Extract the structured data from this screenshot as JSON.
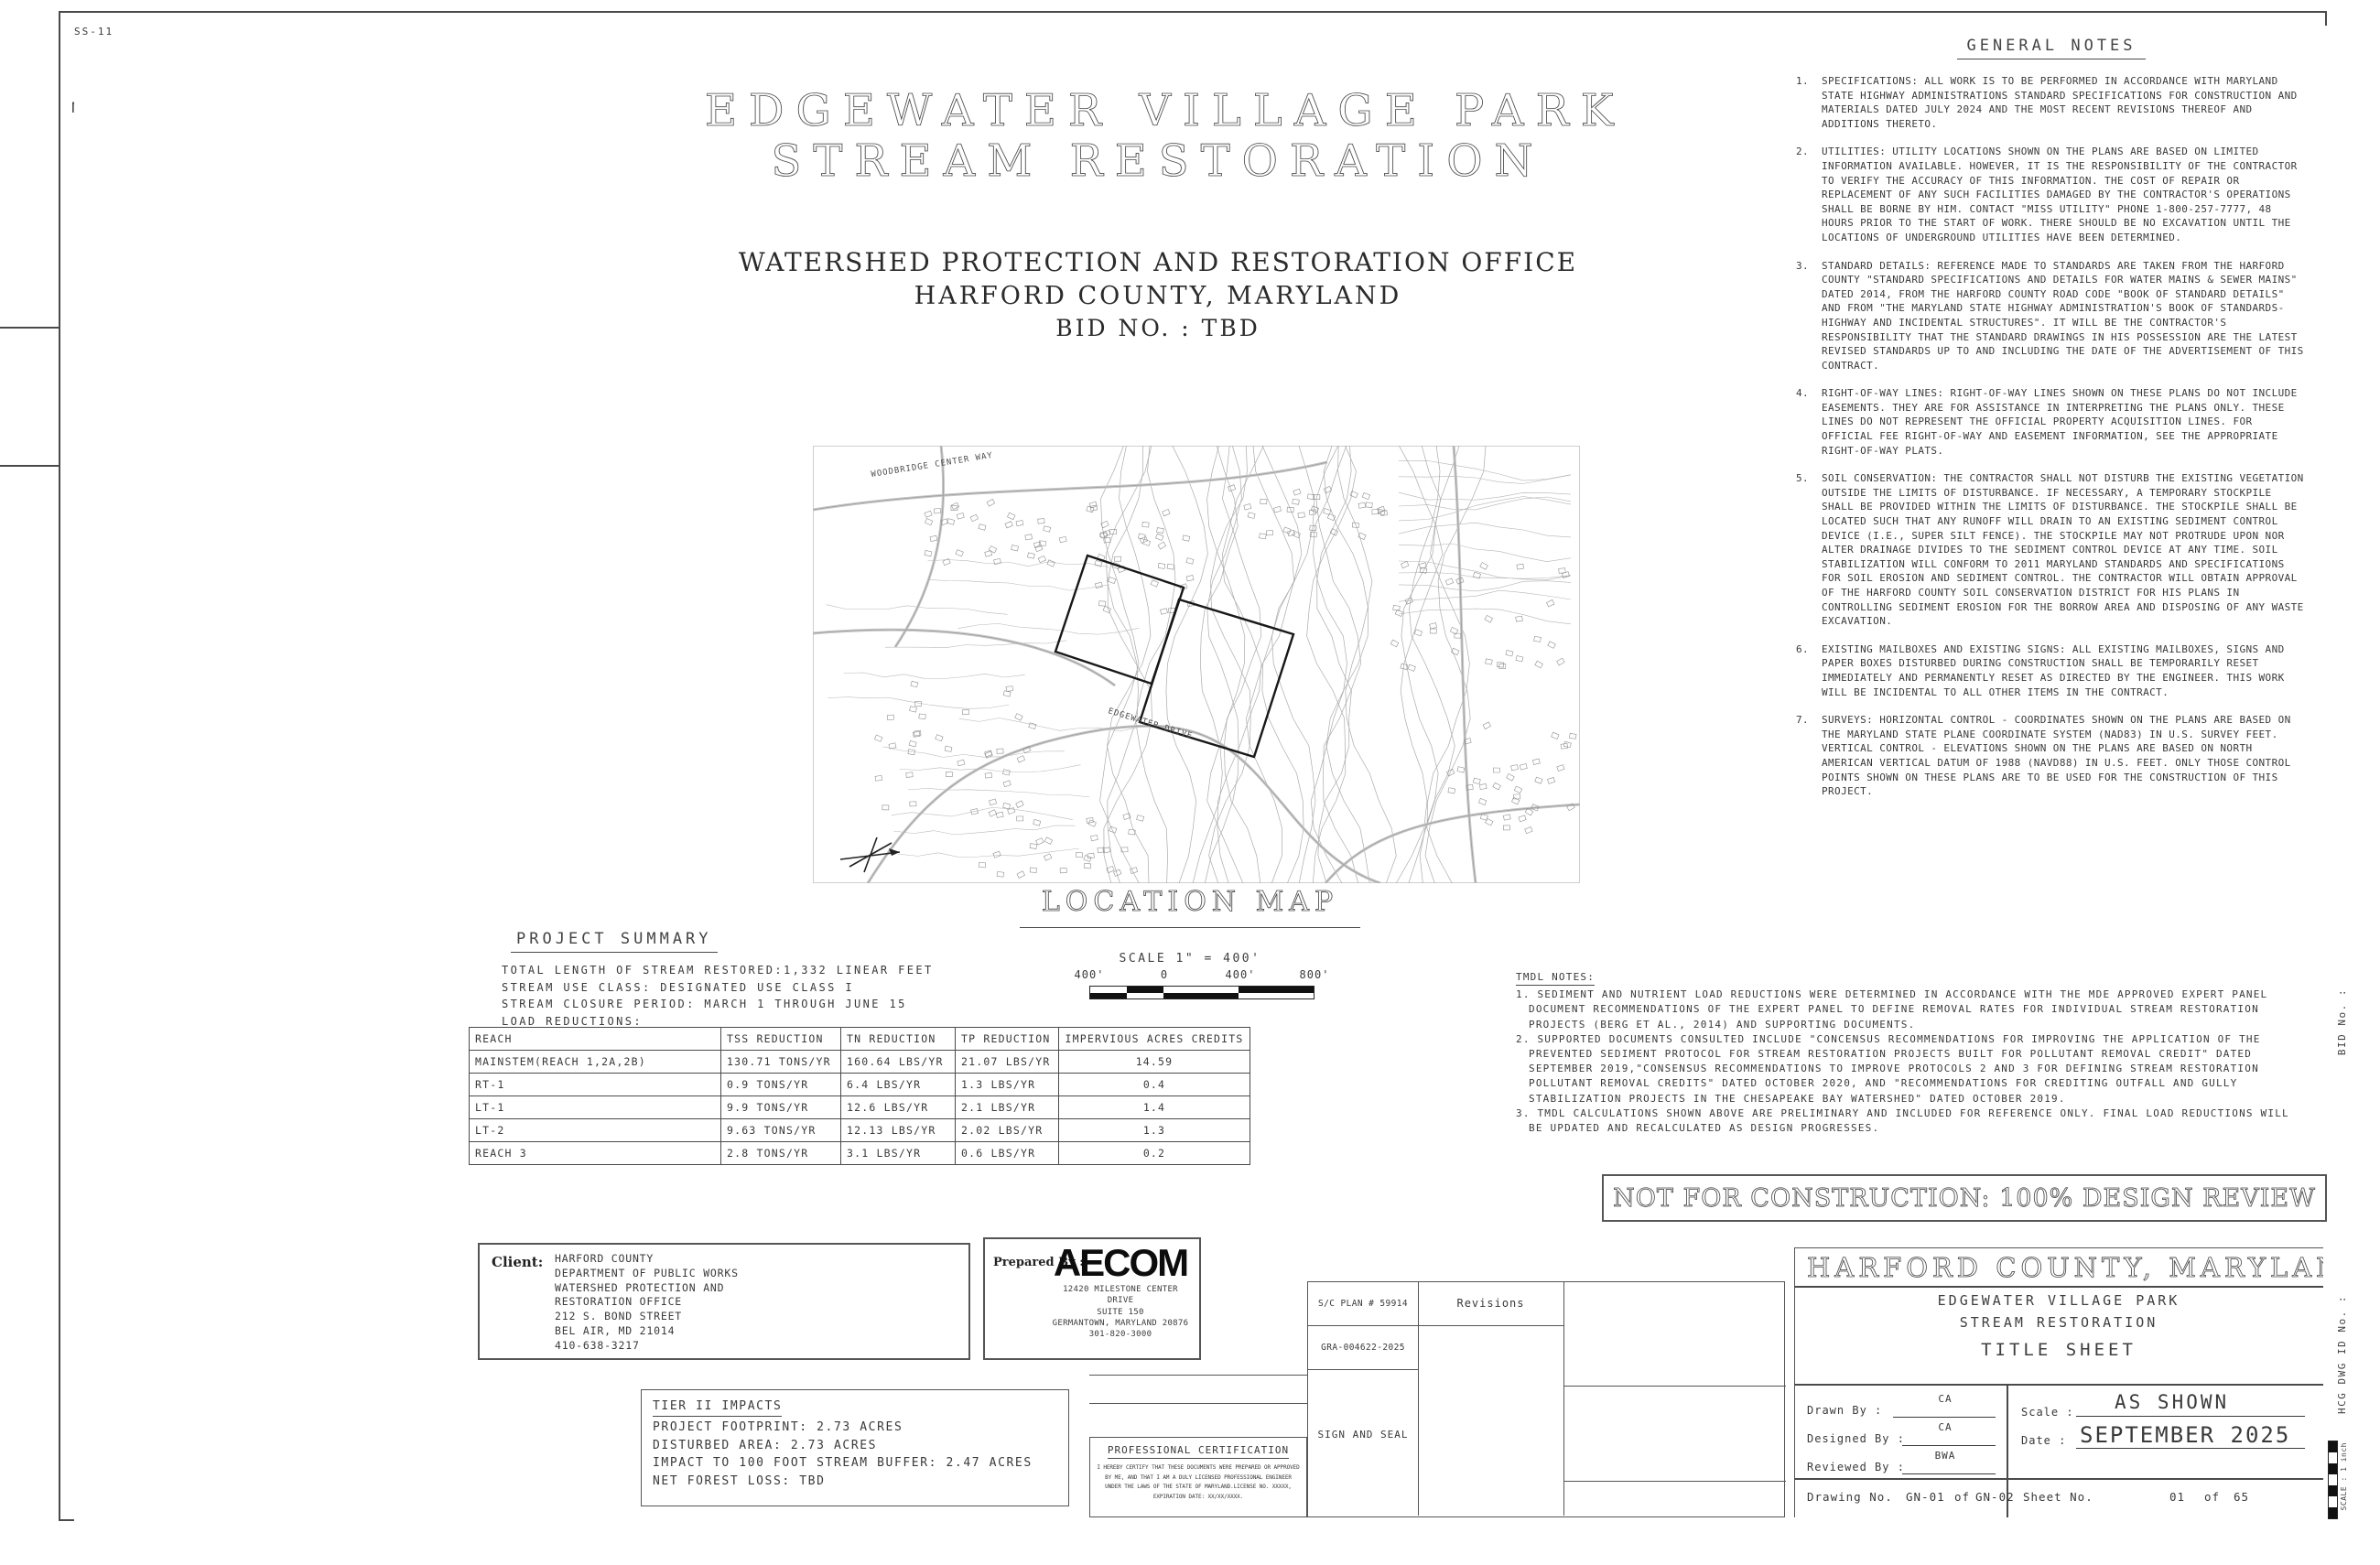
{
  "index": {
    "title": "INDEX OF SHEETS",
    "col_no": "NO.",
    "col_desc": "DESCRIPTION",
    "col_sheet_line1": "SHEET",
    "col_sheet_line2": "NAME",
    "rows": [
      [
        "1",
        "TITLE SHEET",
        "GN-01"
      ],
      [
        "2",
        "GENERAL CONSTRUCTION NOTES",
        "GN-02"
      ],
      [
        "3",
        "SITE PLAN",
        "SP-01"
      ],
      [
        "4",
        "EXISTING CONDITIONS",
        "EX-01"
      ],
      [
        "5",
        "EXISTING CONDITIONS",
        "EX-02"
      ],
      [
        "6",
        "FOREST CONSERVATION PLAN",
        "FC-01"
      ],
      [
        "7",
        "FOREST CONSERVATION PLAN",
        "FC-02"
      ],
      [
        "8",
        "FOREST CONSERVATION TABLE",
        "FC-03"
      ],
      [
        "9",
        "PROPOSED CONDITIONS",
        "SR-01"
      ],
      [
        "10",
        "PROPOSED CONDITIONS",
        "SR-02"
      ],
      [
        "11",
        "PROFILE VIEW",
        "PR-01"
      ],
      [
        "12",
        "PROFILE VIEW",
        "PR-02"
      ],
      [
        "13",
        "PROFILE VIEW",
        "PR-03"
      ],
      [
        "14",
        "PROFILE VIEW",
        "PR-04"
      ],
      [
        "15",
        "PROFILE VIEW",
        "PR-05"
      ],
      [
        "16",
        "PROFILE VIEW",
        "PR-06"
      ],
      [
        "17",
        "PROFILE VIEW",
        "PR-07"
      ],
      [
        "18",
        "PROFILE VIEW",
        "PR-08"
      ],
      [
        "19",
        "GEOMETRIC LAYOUT",
        "GS-01"
      ],
      [
        "20",
        "LINE AND CURVE TABLES",
        "GS-02"
      ],
      [
        "21",
        "STRUCTURE TABLES",
        "ST-01"
      ],
      [
        "22",
        "STREAM CROSS SECTIONS",
        "XS-01"
      ],
      [
        "23",
        "STREAM CROSS SECTIONS",
        "XS-02"
      ],
      [
        "24",
        "STREAM CROSS SECTION",
        "XS-03"
      ],
      [
        "25",
        "SECTION VIEW",
        "SE-01"
      ],
      [
        "26",
        "SECTION VIEW",
        "SE-02"
      ],
      [
        "27",
        "SECTION VIEW",
        "SE-03"
      ],
      [
        "28",
        "SECTION VIEW",
        "SE-04"
      ],
      [
        "29",
        "SECTION VIEW",
        "SE-05"
      ],
      [
        "30",
        "SECTION VIEW",
        "SE-06"
      ],
      [
        "31",
        "SECTION VIEW",
        "SE-07"
      ],
      [
        "32",
        "SECTION VIEW",
        "SE-08"
      ],
      [
        "33",
        "SECTION VIEW",
        "SE-09"
      ],
      [
        "34",
        "SECTION VIEWS",
        "SE-10"
      ],
      [
        "35",
        "SECTION VIEW",
        "SE-11"
      ],
      [
        "36",
        "SECTION VIEW",
        "SE-12"
      ],
      [
        "37",
        "STREAM DETAILS",
        "DE-01"
      ],
      [
        "38",
        "STREAM DETAILS",
        "DE-02"
      ],
      [
        "39",
        "STREAM DETAILS",
        "DE-03"
      ],
      [
        "40",
        "STREAM DETAILS",
        "DE-04"
      ],
      [
        "41",
        "STREAM DETAILS",
        "DE-05"
      ],
      [
        "42",
        "STREAM DETAILS",
        "DE-06"
      ],
      [
        "43",
        "SEQUENCE OF CONSTRUCTION",
        "SC-01"
      ],
      [
        "44",
        "ESC PLAN",
        "ES-01"
      ],
      [
        "45",
        "ESC PLAN",
        "ES-02"
      ],
      [
        "46",
        "ESC DETAILS",
        "ED-01"
      ],
      [
        "47",
        "ESC DETAILS",
        "ED-02"
      ],
      [
        "48",
        "ESC DETAILS",
        "ED-03"
      ],
      [
        "49",
        "MAINTENENCE OF TRAFFIC",
        "MT-01"
      ],
      [
        "50",
        "LANDSCAPING PLAN",
        "LP-01"
      ],
      [
        "51",
        "LANDSCAPING PLAN",
        "LP-02"
      ],
      [
        "52",
        "LANDSCAPING DETAILS",
        "LD-01"
      ],
      [
        "53",
        "LANDSCAPING DETAILS",
        "LD-02"
      ],
      [
        "54",
        "DRAINAGE AREA",
        "DA-01"
      ],
      [
        "55",
        "TITLE SHEET",
        "SS-01"
      ],
      [
        "56",
        "SEWER CONSTRUCTION NOTES",
        "SS-02"
      ],
      [
        "57",
        "SEQUENCE OF CONSTRUCTION",
        "SS-03"
      ],
      [
        "58",
        "EXISTING CONDITIONS",
        "SS-04"
      ],
      [
        "59",
        "EXISTING CONDITIONS",
        "SS-05"
      ],
      [
        "60",
        "SANITARY SEWER PLAN AND PROFILE",
        "SS-06"
      ],
      [
        "61",
        "SANITARY SEWER PLAN AND PROFILE",
        "SS-07"
      ],
      [
        "62",
        "BYPASS PUMPING PLAN",
        "SS-08"
      ],
      [
        "63",
        "SEWER DETAILS",
        "SS-09"
      ],
      [
        "64",
        "SEWER DETAILS",
        "SS-10"
      ],
      [
        "65",
        "SEWER DETAILS",
        "SS-11"
      ]
    ]
  },
  "main_title": {
    "line1": "EDGEWATER  VILLAGE  PARK",
    "line2": "STREAM  RESTORATION",
    "sub1": "WATERSHED  PROTECTION  AND  RESTORATION  OFFICE",
    "sub2": "HARFORD  COUNTY,  MARYLAND",
    "sub3": "BID  NO. : TBD"
  },
  "location_map": {
    "label": "LOCATION MAP",
    "scale_text": "SCALE 1\" = 400'",
    "scale_ticks": [
      "400'",
      "0",
      "400'",
      "800'"
    ],
    "road_labels": [
      "WOODBRIDGE CENTER WAY",
      "EDGEWATER DRIVE"
    ]
  },
  "project_summary": {
    "title": "PROJECT SUMMARY",
    "lines": [
      "TOTAL LENGTH OF STREAM RESTORED:1,332 LINEAR FEET",
      "STREAM USE CLASS: DESIGNATED USE CLASS I",
      "STREAM CLOSURE PERIOD: MARCH 1 THROUGH JUNE 15",
      "LOAD REDUCTIONS:"
    ],
    "table": {
      "headers": [
        "REACH",
        "TSS REDUCTION",
        "TN REDUCTION",
        "TP REDUCTION",
        "IMPERVIOUS ACRES CREDITS"
      ],
      "rows": [
        [
          "MAINSTEM(REACH 1,2A,2B)",
          "130.71 TONS/YR",
          "160.64 LBS/YR",
          "21.07 LBS/YR",
          "14.59"
        ],
        [
          "RT-1",
          "0.9 TONS/YR",
          "6.4 LBS/YR",
          "1.3 LBS/YR",
          "0.4"
        ],
        [
          "LT-1",
          "9.9 TONS/YR",
          "12.6 LBS/YR",
          "2.1 LBS/YR",
          "1.4"
        ],
        [
          "LT-2",
          "9.63 TONS/YR",
          "12.13 LBS/YR",
          "2.02 LBS/YR",
          "1.3"
        ],
        [
          "REACH 3",
          "2.8 TONS/YR",
          "3.1 LBS/YR",
          "0.6 LBS/YR",
          "0.2"
        ]
      ]
    }
  },
  "general_notes": {
    "title": "GENERAL NOTES",
    "notes": [
      {
        "num": "1.",
        "text": "SPECIFICATIONS: ALL WORK IS TO BE PERFORMED IN ACCORDANCE WITH MARYLAND STATE HIGHWAY ADMINISTRATIONS STANDARD SPECIFICATIONS FOR CONSTRUCTION AND MATERIALS DATED JULY 2024 AND THE MOST RECENT REVISIONS THEREOF AND ADDITIONS THERETO."
      },
      {
        "num": "2.",
        "text": "UTILITIES: UTILITY LOCATIONS SHOWN ON THE PLANS ARE BASED ON LIMITED INFORMATION AVAILABLE. HOWEVER, IT IS THE RESPONSIBILITY OF THE CONTRACTOR TO VERIFY THE ACCURACY OF THIS INFORMATION. THE COST OF REPAIR OR REPLACEMENT OF ANY SUCH FACILITIES DAMAGED BY THE CONTRACTOR'S OPERATIONS SHALL BE BORNE BY HIM. CONTACT \"MISS UTILITY\" PHONE 1-800-257-7777, 48 HOURS PRIOR TO THE START OF WORK. THERE SHOULD BE NO EXCAVATION UNTIL THE LOCATIONS OF UNDERGROUND UTILITIES HAVE BEEN DETERMINED."
      },
      {
        "num": "3.",
        "text": "STANDARD DETAILS: REFERENCE MADE TO STANDARDS ARE TAKEN FROM THE HARFORD COUNTY \"STANDARD SPECIFICATIONS AND DETAILS FOR WATER MAINS & SEWER MAINS\" DATED 2014, FROM THE HARFORD COUNTY ROAD CODE \"BOOK OF STANDARD DETAILS\" AND FROM \"THE MARYLAND STATE HIGHWAY ADMINISTRATION'S BOOK OF STANDARDS-HIGHWAY AND INCIDENTAL STRUCTURES\". IT WILL BE THE CONTRACTOR'S RESPONSIBILITY THAT THE STANDARD DRAWINGS IN HIS POSSESSION ARE THE LATEST REVISED STANDARDS UP TO AND INCLUDING THE DATE OF THE ADVERTISEMENT OF THIS CONTRACT."
      },
      {
        "num": "4.",
        "text": "RIGHT-OF-WAY LINES: RIGHT-OF-WAY LINES SHOWN ON THESE PLANS DO NOT INCLUDE EASEMENTS. THEY ARE FOR ASSISTANCE IN INTERPRETING THE PLANS ONLY. THESE LINES DO NOT REPRESENT THE OFFICIAL PROPERTY ACQUISITION LINES. FOR OFFICIAL FEE RIGHT-OF-WAY AND EASEMENT INFORMATION, SEE THE APPROPRIATE RIGHT-OF-WAY PLATS."
      },
      {
        "num": "5.",
        "text": "SOIL CONSERVATION: THE CONTRACTOR SHALL NOT DISTURB THE EXISTING VEGETATION OUTSIDE THE LIMITS OF DISTURBANCE. IF NECESSARY, A TEMPORARY STOCKPILE SHALL BE PROVIDED WITHIN THE LIMITS OF DISTURBANCE. THE STOCKPILE SHALL BE LOCATED SUCH THAT ANY RUNOFF WILL DRAIN TO AN EXISTING SEDIMENT CONTROL DEVICE (I.E., SUPER SILT FENCE). THE STOCKPILE MAY NOT PROTRUDE UPON NOR ALTER DRAINAGE DIVIDES TO THE SEDIMENT CONTROL DEVICE AT ANY TIME. SOIL STABILIZATION WILL CONFORM TO 2011 MARYLAND STANDARDS AND SPECIFICATIONS FOR SOIL EROSION AND SEDIMENT CONTROL.  THE CONTRACTOR WILL OBTAIN APPROVAL OF THE HARFORD COUNTY SOIL CONSERVATION DISTRICT FOR HIS PLANS IN CONTROLLING SEDIMENT EROSION FOR THE BORROW AREA AND DISPOSING OF ANY WASTE EXCAVATION."
      },
      {
        "num": "6.",
        "text": "EXISTING MAILBOXES AND EXISTING SIGNS: ALL EXISTING MAILBOXES, SIGNS AND PAPER BOXES DISTURBED DURING CONSTRUCTION SHALL BE TEMPORARILY RESET IMMEDIATELY AND PERMANENTLY RESET AS DIRECTED BY THE ENGINEER. THIS WORK WILL BE INCIDENTAL TO ALL OTHER ITEMS IN THE CONTRACT."
      },
      {
        "num": "7.",
        "text": "SURVEYS: HORIZONTAL CONTROL - COORDINATES SHOWN ON THE PLANS ARE BASED ON THE MARYLAND STATE PLANE COORDINATE SYSTEM (NAD83) IN U.S. SURVEY FEET.  VERTICAL CONTROL - ELEVATIONS SHOWN ON THE PLANS ARE BASED ON NORTH AMERICAN VERTICAL DATUM OF 1988 (NAVD88) IN U.S. FEET.  ONLY THOSE CONTROL POINTS SHOWN ON THESE PLANS ARE TO BE USED FOR THE CONSTRUCTION OF THIS PROJECT."
      }
    ]
  },
  "tmdl_notes": {
    "title": "TMDL NOTES:",
    "items": [
      "1. SEDIMENT AND NUTRIENT LOAD REDUCTIONS WERE DETERMINED IN ACCORDANCE WITH THE MDE APPROVED EXPERT PANEL DOCUMENT RECOMMENDATIONS OF THE EXPERT PANEL TO DEFINE REMOVAL RATES FOR INDIVIDUAL STREAM RESTORATION PROJECTS (BERG ET AL., 2014) AND SUPPORTING DOCUMENTS.",
      "2. SUPPORTED DOCUMENTS CONSULTED INCLUDE \"CONCENSUS RECOMMENDATIONS FOR IMPROVING THE APPLICATION OF THE PREVENTED SEDIMENT PROTOCOL FOR STREAM RESTORATION PROJECTS BUILT FOR POLLUTANT REMOVAL CREDIT\" DATED SEPTEMBER 2019,\"CONSENSUS RECOMMENDATIONS TO IMPROVE PROTOCOLS 2 AND 3 FOR DEFINING STREAM RESTORATION POLLUTANT REMOVAL CREDITS\" DATED OCTOBER 2020, AND \"RECOMMENDATIONS FOR CREDITING OUTFALL AND GULLY STABILIZATION PROJECTS IN THE CHESAPEAKE BAY WATERSHED\" DATED OCTOBER 2019.",
      "3. TMDL CALCULATIONS SHOWN ABOVE ARE PRELIMINARY AND INCLUDED FOR REFERENCE ONLY. FINAL LOAD REDUCTIONS WILL BE UPDATED AND RECALCULATED AS DESIGN PROGRESSES."
    ]
  },
  "banner": "NOT FOR CONSTRUCTION: 100% DESIGN REVIEW",
  "client_block": {
    "label": "Client:",
    "lines": [
      "HARFORD COUNTY",
      "DEPARTMENT OF PUBLIC WORKS",
      "WATERSHED PROTECTION AND",
      "RESTORATION OFFICE",
      "212 S. BOND STREET",
      "BEL AIR, MD 21014",
      "410-638-3217"
    ]
  },
  "prepared_block": {
    "label": "Prepared  By  :",
    "logo": "AECOM",
    "lines": [
      "12420 MILESTONE CENTER DRIVE",
      "SUITE 150",
      "GERMANTOWN, MARYLAND 20876",
      "301-820-3000"
    ]
  },
  "tier2": {
    "title": "TIER II IMPACTS",
    "lines": [
      "PROJECT FOOTPRINT: 2.73 ACRES",
      "DISTURBED AREA:  2.73 ACRES",
      "IMPACT TO 100 FOOT STREAM BUFFER: 2.47 ACRES",
      "NET FOREST LOSS: TBD"
    ]
  },
  "cert": {
    "title": "PROFESSIONAL CERTIFICATION",
    "body": "I HEREBY CERTIFY THAT THESE DOCUMENTS WERE PREPARED OR APPROVED BY ME, AND THAT I AM A DULY LICENSED PROFESSIONAL ENGINEER UNDER THE LAWS OF THE STATE OF MARYLAND.LICENSE NO. XXXXX, EXPIRATION DATE: XX/XX/XXXX."
  },
  "revisions_block": {
    "sc_plan": "S/C PLAN # 59914",
    "gra": "GRA-004622-2025",
    "sign_seal": "SIGN AND SEAL",
    "revisions_label": "Revisions"
  },
  "title_block": {
    "region": "HARFORD COUNTY, MARYLAND",
    "project1": "EDGEWATER VILLAGE PARK",
    "project2": "STREAM RESTORATION",
    "sheet_title": "TITLE SHEET",
    "drawn_label": "Drawn By :",
    "drawn": "CA",
    "designed_label": "Designed By :",
    "designed": "CA",
    "reviewed_label": "Reviewed By :",
    "reviewed": "BWA",
    "scale_label": "Scale :",
    "scale": "AS SHOWN",
    "date_label": "Date :",
    "date": "SEPTEMBER 2025",
    "drawing_label": "Drawing No.",
    "drawing_no": "GN-01",
    "of1": "of",
    "drawing_no2": "GN-02",
    "sheet_label": "Sheet No.",
    "sheet_no": "01",
    "of2": "of",
    "sheet_total": "65"
  },
  "edge": {
    "bid": "BID No. :",
    "hcg": "HCG DWG ID No. :",
    "scale_edge": "SCALE : 1 inch"
  },
  "colors": {
    "line": "#4a4a4a",
    "text": "#3a3a3a",
    "black": "#111111"
  }
}
